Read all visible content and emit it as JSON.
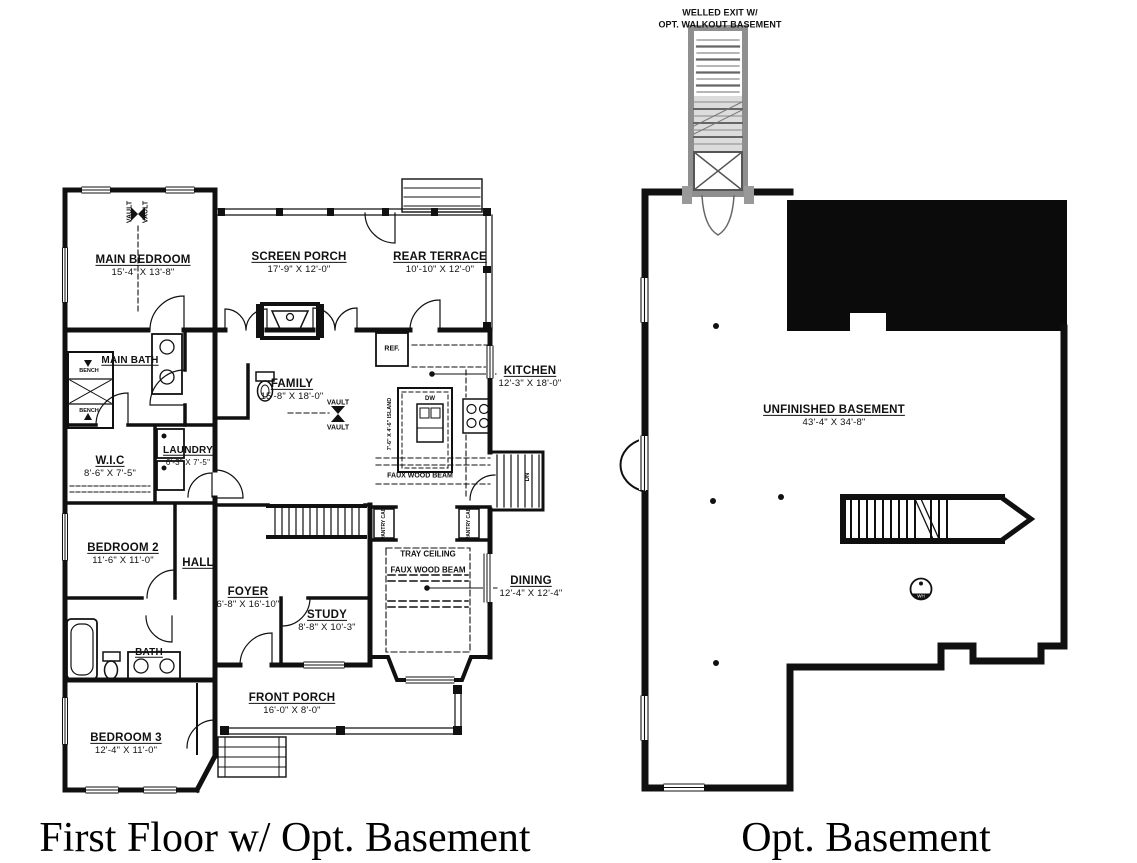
{
  "captions": {
    "first_floor": "First Floor w/ Opt. Basement",
    "basement": "Opt. Basement"
  },
  "first_floor": {
    "rooms": [
      {
        "name": "MAIN BEDROOM",
        "dims": "15'-4\" X 13'-8\""
      },
      {
        "name": "SCREEN PORCH",
        "dims": "17'-9\" X 12'-0\""
      },
      {
        "name": "REAR TERRACE",
        "dims": "10'-10\" X 12'-0\""
      },
      {
        "name": "MAIN BATH",
        "dims": ""
      },
      {
        "name": "FAMILY",
        "dims": "15'-8\" X 18'-0\""
      },
      {
        "name": "KITCHEN",
        "dims": "12'-3\" X 18'-0\""
      },
      {
        "name": "W.I.C",
        "dims": "8'-6\" X 7'-5\""
      },
      {
        "name": "LAUNDRY",
        "dims": "6'-3\" X 7'-5\""
      },
      {
        "name": "BEDROOM 2",
        "dims": "11'-6\" X 11'-0\""
      },
      {
        "name": "HALL",
        "dims": ""
      },
      {
        "name": "FOYER",
        "dims": "6'-8\" X 16'-10\""
      },
      {
        "name": "STUDY",
        "dims": "8'-8\" X 10'-3\""
      },
      {
        "name": "BATH",
        "dims": ""
      },
      {
        "name": "FRONT PORCH",
        "dims": "16'-0\" X 8'-0\""
      },
      {
        "name": "BEDROOM 3",
        "dims": "12'-4\" X 11'-0\""
      },
      {
        "name": "DINING",
        "dims": "12'-4\" X 12'-4\""
      }
    ],
    "annotations": {
      "vault": "VAULT",
      "bench": "BENCH",
      "ref": "REF.",
      "dw": "DW",
      "dn": "DN",
      "island": "7'-6\" X 4'-6\" ISLAND",
      "faux_wood_beam": "FAUX WOOD BEAM",
      "tray_ceiling": "TRAY CEILING",
      "pantry_cab": "PANTRY CAB."
    }
  },
  "basement": {
    "exit_label_line1": "WELLED EXIT W/",
    "exit_label_line2": "OPT. WALKOUT BASEMENT",
    "room": {
      "name": "UNFINISHED BASEMENT",
      "dims": "43'-4\" X 34'-8\""
    },
    "water_heater": "WH"
  }
}
